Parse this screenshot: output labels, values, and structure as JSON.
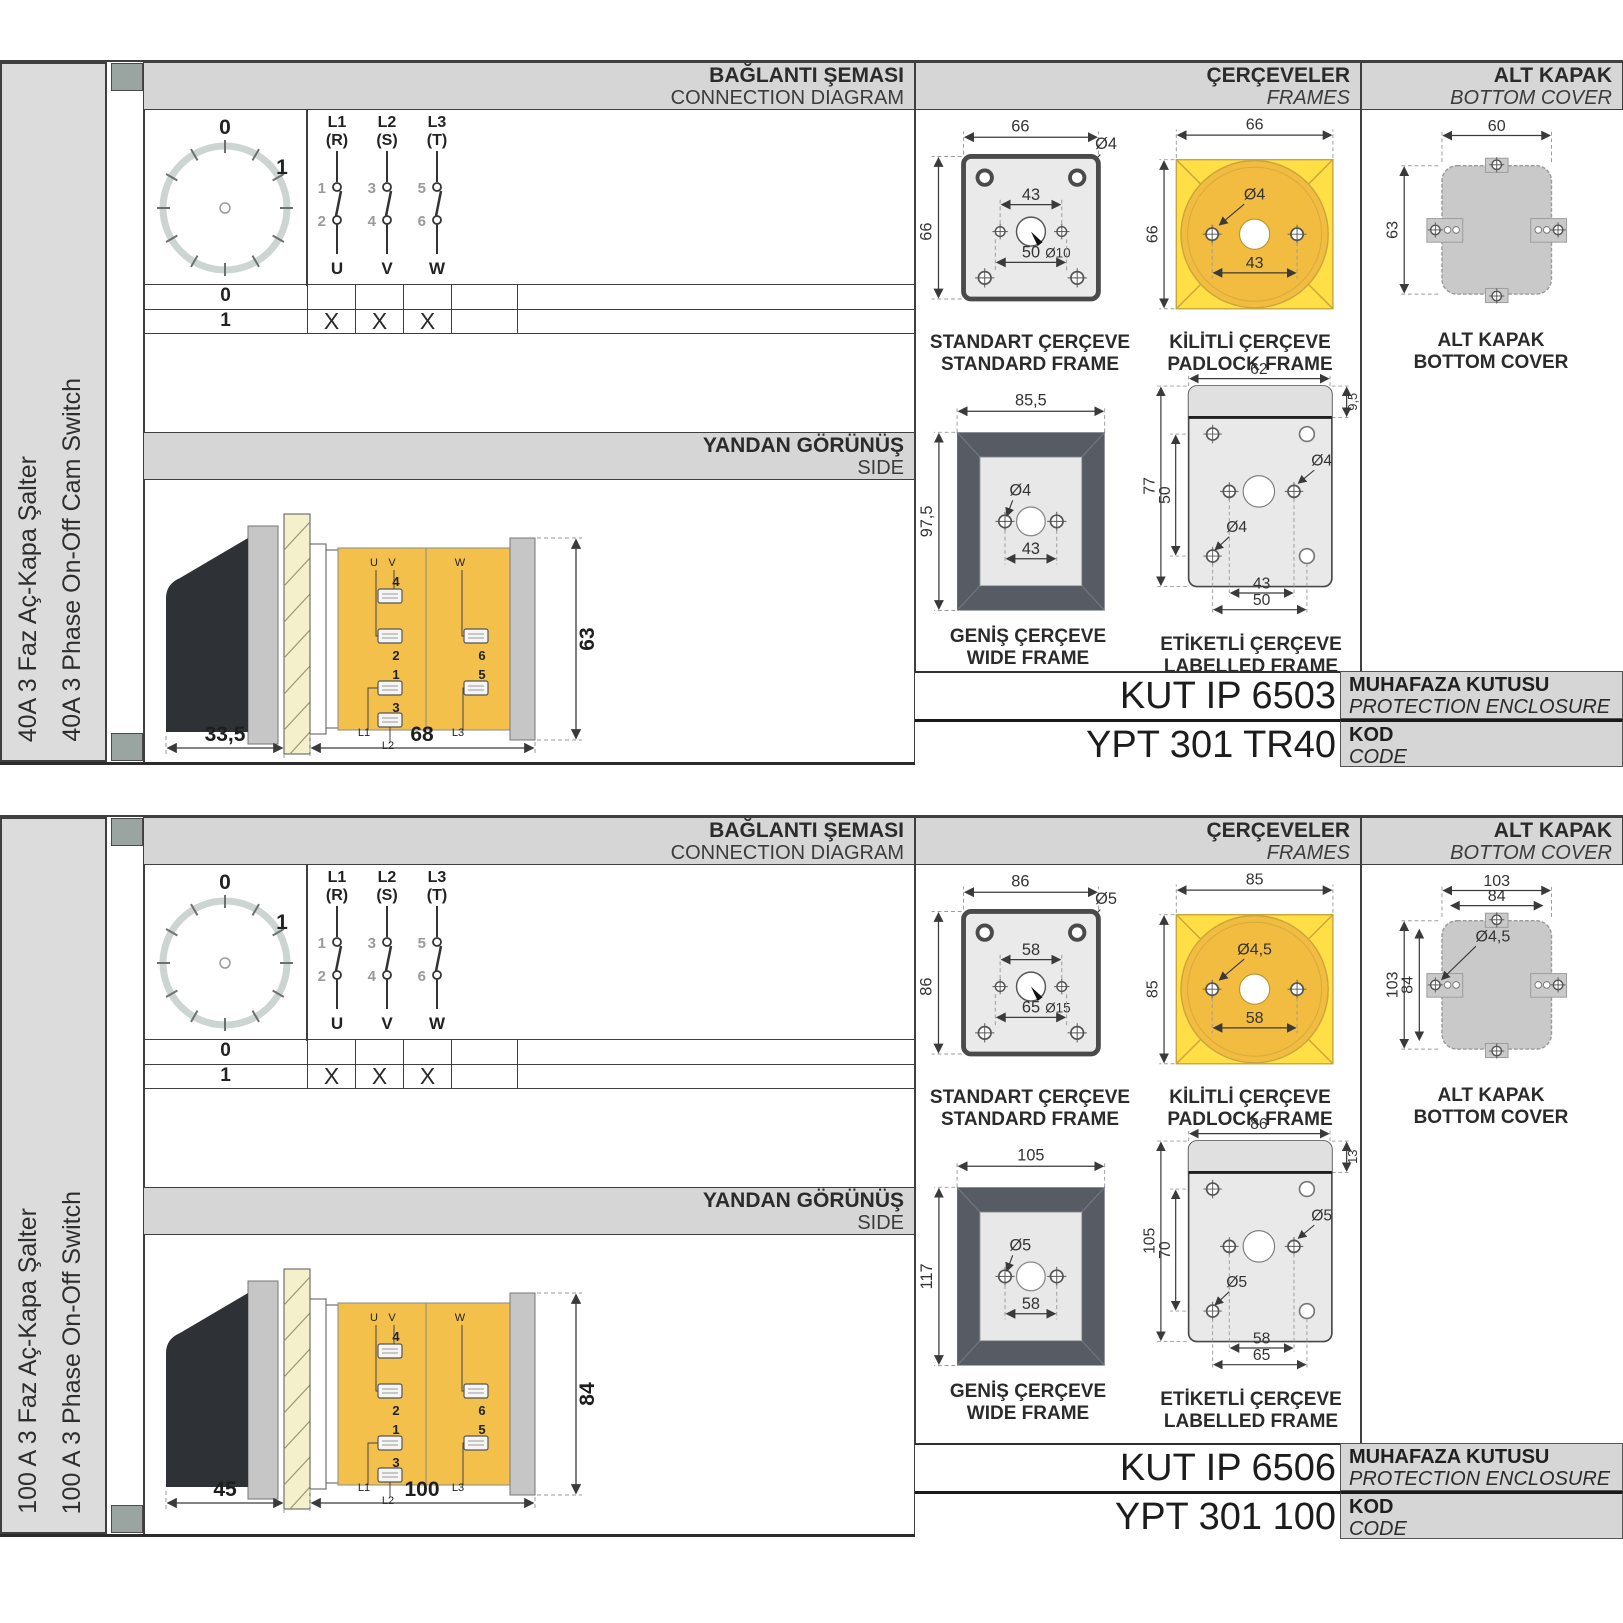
{
  "colors": {
    "accent_yellow": "#FFDF45",
    "body_yellow": "#F3C14B",
    "frame_dark": "#565B64",
    "band_gray": "#D6D6D6",
    "cover_gray": "#C9C9C9",
    "sidebar_gray": "#DCDCDC"
  },
  "sections": [
    {
      "sidebar": {
        "title_tr": "40A 3 Faz Aç-Kapa Şalter",
        "title_en": "40A 3 Phase On-Off Cam Switch"
      },
      "headers": {
        "connection_tr": "BAĞLANTI ŞEMASI",
        "connection_en": "CONNECTION DIAGRAM",
        "frames_tr": "ÇERÇEVELER",
        "frames_en": "FRAMES",
        "cover_tr": "ALT KAPAK",
        "cover_en": "BOTTOM COVER",
        "side_tr": "YANDAN GÖRÜNÜŞ",
        "side_en": "SIDE"
      },
      "connection": {
        "dial": {
          "pos0": "0",
          "pos1": "1"
        },
        "poles": [
          {
            "line": "L1",
            "phase": "(R)",
            "n_top": "1",
            "n_bot": "2",
            "out": "U"
          },
          {
            "line": "L2",
            "phase": "(S)",
            "n_top": "3",
            "n_bot": "4",
            "out": "V"
          },
          {
            "line": "L3",
            "phase": "(T)",
            "n_top": "5",
            "n_bot": "6",
            "out": "W"
          }
        ],
        "table": {
          "rows": [
            {
              "label": "0",
              "cells": [
                "",
                "",
                ""
              ]
            },
            {
              "label": "1",
              "cells": [
                "X",
                "X",
                "X"
              ]
            }
          ]
        }
      },
      "side_view": {
        "depth_handle": "33,5",
        "depth_body": "68",
        "height": "63",
        "labels": {
          "u": "U",
          "v": "V",
          "w": "W",
          "t4": "4",
          "t2": "2",
          "t6": "6",
          "t1": "1",
          "t5": "5",
          "t3": "3",
          "l1": "L1",
          "l2": "L2",
          "l3": "L3"
        }
      },
      "figures": {
        "standard": {
          "w": "66",
          "h": "66",
          "hole": "Ø4",
          "inner": "43",
          "center": "Ø10",
          "bottom": "50",
          "cap_tr": "STANDART ÇERÇEVE",
          "cap_en": "STANDARD FRAME"
        },
        "padlock": {
          "w": "66",
          "h": "66",
          "hole": "Ø4",
          "inner": "43",
          "cap_tr": "KİLİTLİ ÇERÇEVE",
          "cap_en": "PADLOCK FRAME"
        },
        "wide": {
          "w": "85,5",
          "h": "97,5",
          "hole": "Ø4",
          "inner": "43",
          "cap_tr": "GENİŞ ÇERÇEVE",
          "cap_en": "WIDE FRAME"
        },
        "labelled": {
          "w": "62",
          "strip": "9,5",
          "h": "77",
          "inner_v": "50",
          "hole_a": "Ø4",
          "hole_b": "Ø4",
          "inner": "43",
          "bottom": "50",
          "cap_tr": "ETİKETLİ ÇERÇEVE",
          "cap_en": "LABELLED FRAME"
        },
        "cover": {
          "w": "60",
          "h": "63",
          "w2": "",
          "h2": "",
          "hole": "",
          "cap_tr": "ALT KAPAK",
          "cap_en": "BOTTOM COVER"
        }
      },
      "codes": {
        "enclosure": "KUT IP 6503",
        "enclosure_tr": "MUHAFAZA KUTUSU",
        "enclosure_en": "PROTECTION ENCLOSURE",
        "code": "YPT 301 TR40",
        "code_tr": "KOD",
        "code_en": "CODE"
      }
    },
    {
      "sidebar": {
        "title_tr": "100 A 3 Faz Aç-Kapa Şalter",
        "title_en": "100 A 3 Phase On-Off Switch"
      },
      "headers": {
        "connection_tr": "BAĞLANTI ŞEMASI",
        "connection_en": "CONNECTION DIAGRAM",
        "frames_tr": "ÇERÇEVELER",
        "frames_en": "FRAMES",
        "cover_tr": "ALT KAPAK",
        "cover_en": "BOTTOM COVER",
        "side_tr": "YANDAN GÖRÜNÜŞ",
        "side_en": "SIDE"
      },
      "connection": {
        "dial": {
          "pos0": "0",
          "pos1": "1"
        },
        "poles": [
          {
            "line": "L1",
            "phase": "(R)",
            "n_top": "1",
            "n_bot": "2",
            "out": "U"
          },
          {
            "line": "L2",
            "phase": "(S)",
            "n_top": "3",
            "n_bot": "4",
            "out": "V"
          },
          {
            "line": "L3",
            "phase": "(T)",
            "n_top": "5",
            "n_bot": "6",
            "out": "W"
          }
        ],
        "table": {
          "rows": [
            {
              "label": "0",
              "cells": [
                "",
                "",
                ""
              ]
            },
            {
              "label": "1",
              "cells": [
                "X",
                "X",
                "X"
              ]
            }
          ]
        }
      },
      "side_view": {
        "depth_handle": "45",
        "depth_body": "100",
        "height": "84",
        "labels": {
          "u": "U",
          "v": "V",
          "w": "W",
          "t4": "4",
          "t2": "2",
          "t6": "6",
          "t1": "1",
          "t5": "5",
          "t3": "3",
          "l1": "L1",
          "l2": "L2",
          "l3": "L3"
        }
      },
      "figures": {
        "standard": {
          "w": "86",
          "h": "86",
          "hole": "Ø5",
          "inner": "58",
          "center": "Ø15",
          "bottom": "65",
          "cap_tr": "STANDART ÇERÇEVE",
          "cap_en": "STANDARD FRAME"
        },
        "padlock": {
          "w": "85",
          "h": "85",
          "hole": "Ø4,5",
          "inner": "58",
          "cap_tr": "KİLİTLİ ÇERÇEVE",
          "cap_en": "PADLOCK FRAME"
        },
        "wide": {
          "w": "105",
          "h": "117",
          "hole": "Ø5",
          "inner": "58",
          "cap_tr": "GENİŞ ÇERÇEVE",
          "cap_en": "WIDE FRAME"
        },
        "labelled": {
          "w": "86",
          "strip": "13",
          "h": "105",
          "inner_v": "70",
          "hole_a": "Ø5",
          "hole_b": "Ø5",
          "inner": "58",
          "bottom": "65",
          "cap_tr": "ETİKETLİ ÇERÇEVE",
          "cap_en": "LABELLED FRAME"
        },
        "cover": {
          "w": "103",
          "h": "103",
          "w2": "84",
          "h2": "84",
          "hole": "Ø4,5",
          "cap_tr": "ALT KAPAK",
          "cap_en": "BOTTOM COVER"
        }
      },
      "codes": {
        "enclosure": "KUT IP 6506",
        "enclosure_tr": "MUHAFAZA KUTUSU",
        "enclosure_en": "PROTECTION ENCLOSURE",
        "code": "YPT 301 100",
        "code_tr": "KOD",
        "code_en": "CODE"
      }
    }
  ]
}
